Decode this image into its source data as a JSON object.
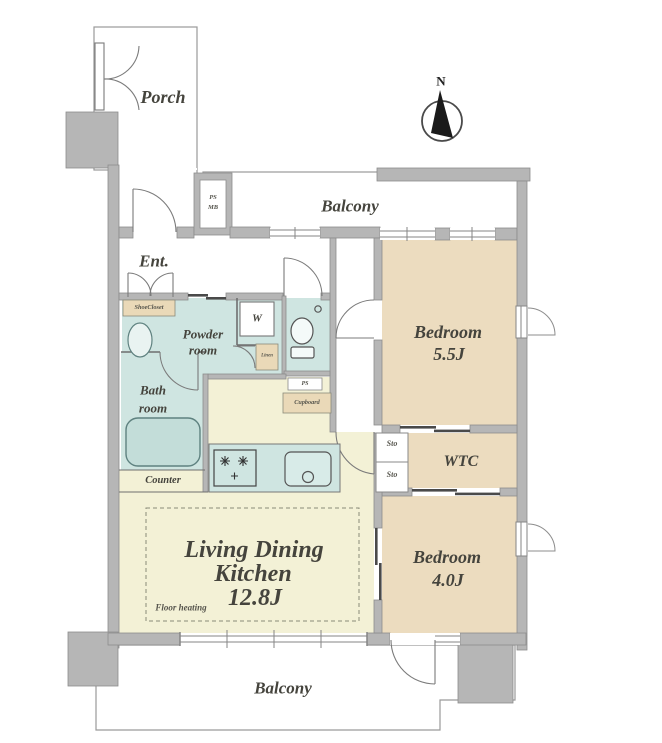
{
  "palette": {
    "wall_gray": "#b6b6b6",
    "wall_edge": "#8d8d8d",
    "bedroom_tan": "#ecdcbf",
    "ldk_yellow": "#f3f1d6",
    "wet_area_teal": "#cfe5e1",
    "label_box_tan": "#ead9b8",
    "line_dark": "#6f6f6f",
    "text": "#45443d"
  },
  "compass": {
    "label": "N"
  },
  "areas": {
    "porch": "Porch",
    "balcony_top": "Balcony",
    "balcony_bottom": "Balcony",
    "entrance": "Ent.",
    "powder_room_line1": "Powder",
    "powder_room_line2": "room",
    "bath_room_line1": "Bath",
    "bath_room_line2": "room",
    "washer": "W",
    "bedroom1_name": "Bedroom",
    "bedroom1_size": "5.5J",
    "bedroom2_name": "Bedroom",
    "bedroom2_size": "4.0J",
    "wtc": "WTC",
    "ldk_line1": "Living Dining",
    "ldk_line2": "Kitchen",
    "ldk_size": "12.8J"
  },
  "closets": {
    "shoe_closet": "ShoeCloset",
    "linen": "Linen",
    "cupboard": "Cupboard",
    "sto_upper": "Sto",
    "sto_lower": "Sto"
  },
  "service": {
    "ps_mb_line1": "PS",
    "ps_mb_line2": "MB",
    "ps": "PS",
    "counter": "Counter",
    "floor_heating": "Floor heating"
  }
}
